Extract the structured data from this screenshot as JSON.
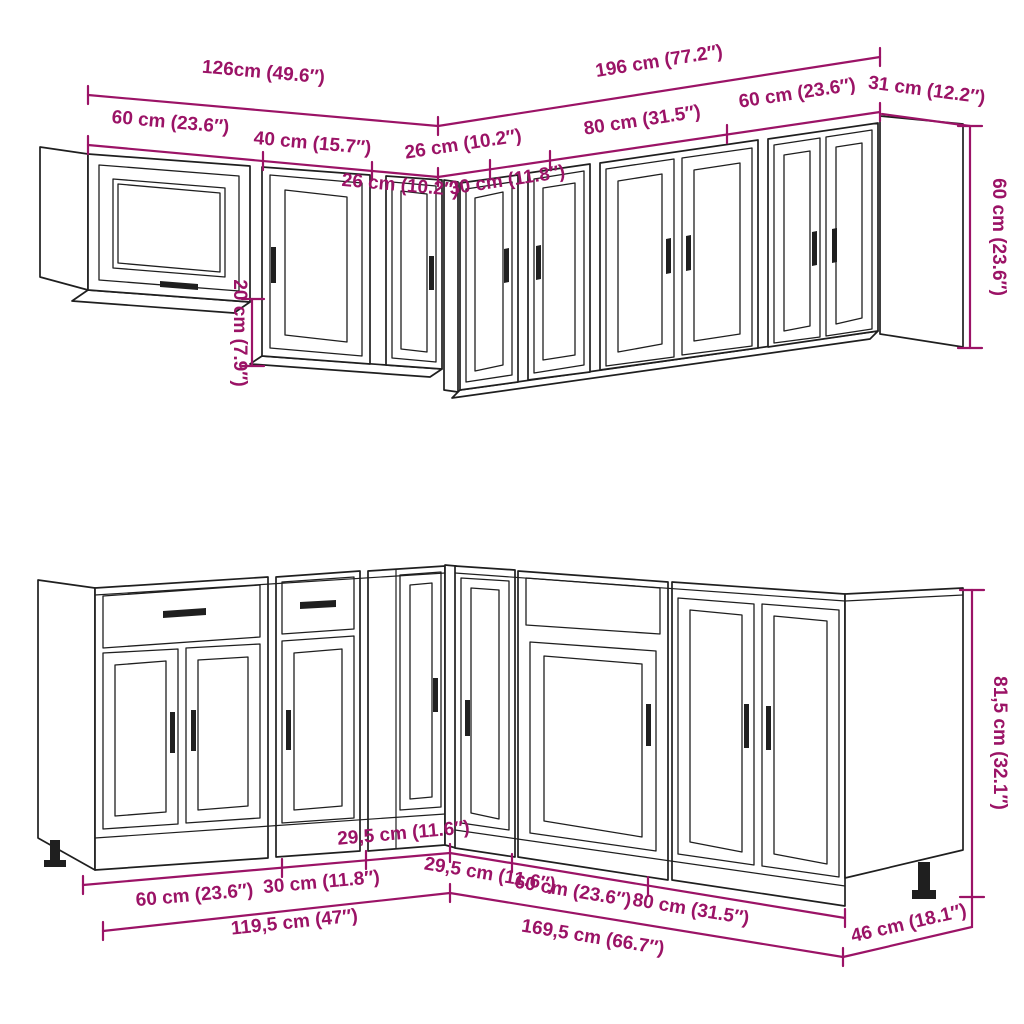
{
  "colors": {
    "dimension_magenta": "#9B1366",
    "drawing_line": "#1F1F1F",
    "background": "#FFFFFF"
  },
  "wall_cabinets": {
    "total_left": "126cm (49.6″)",
    "total_right": "196 cm (77.2″)",
    "seg_60_left": "60 cm (23.6″)",
    "seg_40": "40 cm (15.7″)",
    "seg_26_left": "26 cm (10.2″)",
    "seg_26_right": "26 cm (10.2″)",
    "seg_30": "30 cm (11.8″)",
    "seg_80": "80 cm (31.5″)",
    "seg_60_right": "60 cm (23.6″)",
    "depth": "31 cm (12.2″)",
    "height": "60 cm (23.6″)",
    "drop": "20 cm (7.9″)"
  },
  "base_cabinets": {
    "total_left": "119,5 cm (47″)",
    "total_right": "169,5 cm (66.7″)",
    "seg_60_left": "60 cm (23.6″)",
    "seg_30": "30 cm (11.8″)",
    "seg_295_left": "29,5 cm (11.6″)",
    "seg_295_right": "29,5 cm (11.6″)",
    "seg_60_right": "60 cm (23.6″)",
    "seg_80": "80 cm (31.5″)",
    "depth": "46 cm (18.1″)",
    "height": "81,5 cm (32.1″)"
  }
}
